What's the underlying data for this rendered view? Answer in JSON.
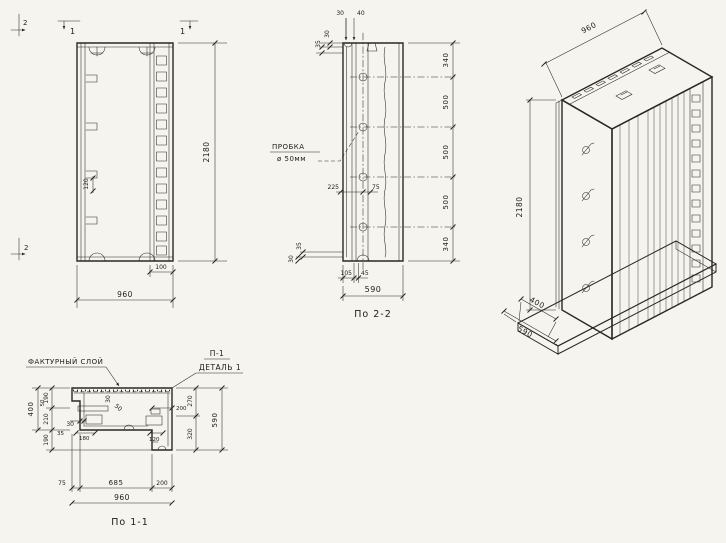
{
  "colors": {
    "paper": "#f6f4ee",
    "ink": "#2b2824"
  },
  "views": {
    "elevation": {
      "mark_1_left": "1",
      "mark_1_right": "1",
      "mark_2_top": "2",
      "mark_2_bottom": "2",
      "dim_height": "2180",
      "dim_width": "960",
      "dim_rib": "100",
      "dim_bracket": "120"
    },
    "section2": {
      "title": "По 2-2",
      "plug_line1": "ПРОБКА",
      "plug_line2": "ø 50мм",
      "dim_top_30": "30",
      "dim_top_40": "40",
      "dim_lt_30": "30",
      "dim_lt_35": "35",
      "dim_lb_35": "35",
      "dim_lb_30": "30",
      "right": [
        "340",
        "500",
        "500",
        "500",
        "340"
      ],
      "dim_225": "225",
      "dim_75": "75",
      "dim_105": "105",
      "dim_45": "45",
      "dim_total": "590"
    },
    "axon": {
      "dim_width": "960",
      "dim_height": "2180",
      "dim_depth_panel": "400",
      "dim_depth_base": "590"
    },
    "section1": {
      "title": "По 1-1",
      "label_facing": "ФАКТУРНЫЙ СЛОЙ",
      "label_p1": "П-1",
      "label_detail": "ДЕТАЛЬ 1",
      "dim_400": "400",
      "dim_190a": "190",
      "dim_210": "210",
      "dim_190b": "190",
      "dim_50a": "50",
      "dim_30a": "30",
      "dim_35": "35",
      "dim_180": "180",
      "dim_30b": "30",
      "dim_50b": "50",
      "dim_200a": "200",
      "dim_120": "120",
      "dim_270": "270",
      "dim_320": "320",
      "dim_590": "590",
      "dim_75": "75",
      "dim_685": "685",
      "dim_200b": "200",
      "dim_960": "960"
    }
  }
}
